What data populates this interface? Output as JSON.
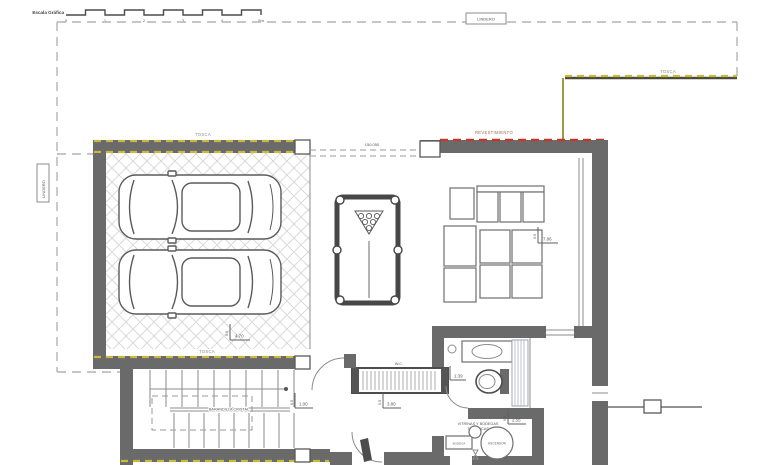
{
  "colors": {
    "wall": "#6a6a6a",
    "tosca_dash": "#c9b93c",
    "revestimiento_dash": "#c0392b",
    "boundary_dash": "#b3b3b3",
    "linework": "#5f5f5f"
  },
  "scale_bar": {
    "title": "Escala Gráfica",
    "ticks": [
      "0",
      "1",
      "2",
      "3",
      "4",
      "5m"
    ]
  },
  "boundary": {
    "top_label": "LINDERO",
    "left_label": "LINDERO"
  },
  "labels": {
    "tosca_top_right": "TOSCA",
    "tosca_garage_top": "TOSCA",
    "tosca_garage_bottom": "TOSCA",
    "revestimiento": "REVESTIMIENTO",
    "level_mark": "150.050",
    "railing": "BARANDILLA CRISTAL",
    "wc": "W.C.",
    "cellar_line1": "VITRINAS Y BODEGAS",
    "cellar_line2": "TEMÁTICAS",
    "elevator": "ASCENSOR",
    "cellar_cabinet": "BODEGA"
  },
  "dims": [
    {
      "id": "garage",
      "v": "0.5",
      "h": "4.70"
    },
    {
      "id": "living",
      "v": "0.5",
      "h": "7.86"
    },
    {
      "id": "bathroom",
      "v": "0.5",
      "h": "1.39"
    },
    {
      "id": "hall-west",
      "v": "0.5",
      "h": "1.00"
    },
    {
      "id": "hall",
      "v": "0.5",
      "h": "3.80"
    },
    {
      "id": "cellar",
      "v": "0.5",
      "h": "2.55"
    }
  ]
}
